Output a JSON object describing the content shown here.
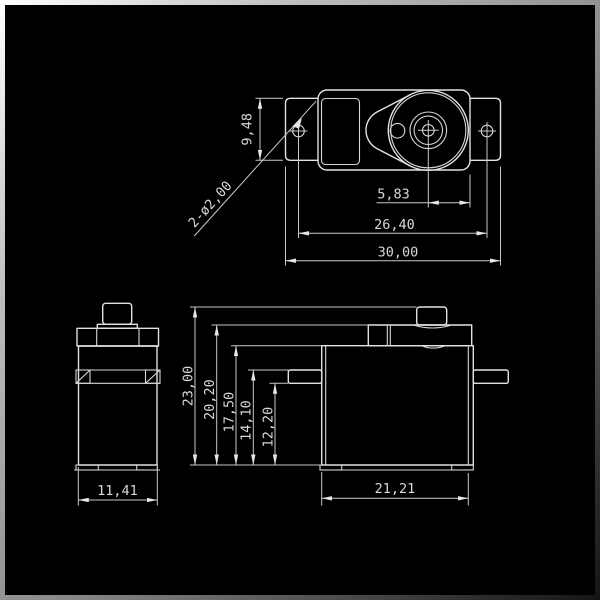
{
  "drawing": {
    "title": "servo-motor-dimension-drawing",
    "background_color": "#000000",
    "line_color": "#e2e2e2",
    "text_color": "#d8d8d8",
    "units_style": "decimal-comma millimeters",
    "top_view": {
      "dims": {
        "tab_height": "9,48",
        "mounting_holes_callout": "2-ø2,00",
        "shaft_to_edge": "5,83",
        "hole_spacing": "26,40",
        "overall_width": "30,00"
      }
    },
    "side_view": {
      "dims": {
        "body_depth": "11,41"
      }
    },
    "front_view": {
      "dims": {
        "overall_height": "23,00",
        "collar_height": "20,20",
        "case_height": "17,50",
        "flange_top_height": "14,10",
        "flange_bottom_height": "12,20",
        "body_width": "21,21"
      }
    }
  }
}
